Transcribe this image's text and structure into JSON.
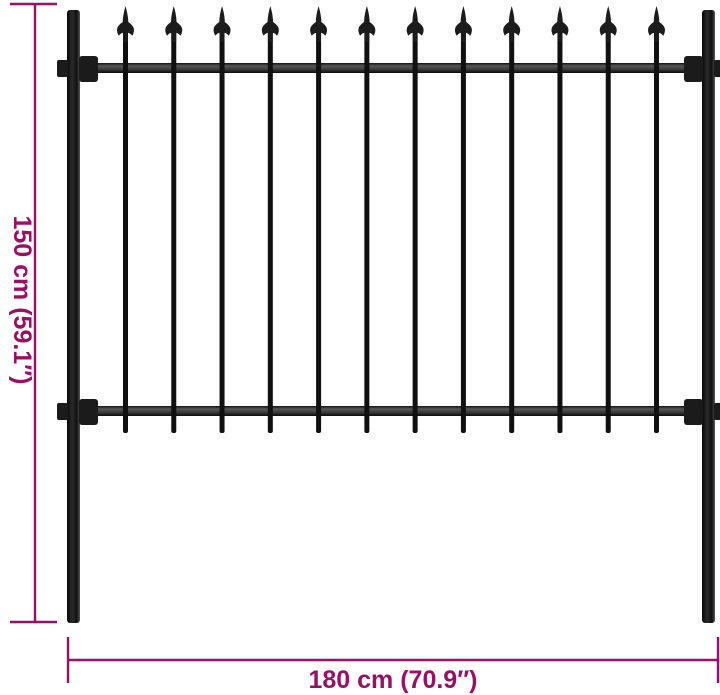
{
  "diagram": {
    "background_color": "#ffffff",
    "annotation_color": "#9A1065",
    "dimensions": {
      "height_label": "150 cm (59.1″)",
      "width_label": "180 cm (70.9″)"
    },
    "fence": {
      "picket_count": 12,
      "post_color": "#161616",
      "rail_color": "#3d3d3d",
      "picket_color": "#101010",
      "finial_color": "#1c1c1c",
      "bracket_color": "#1b1b1b"
    }
  }
}
